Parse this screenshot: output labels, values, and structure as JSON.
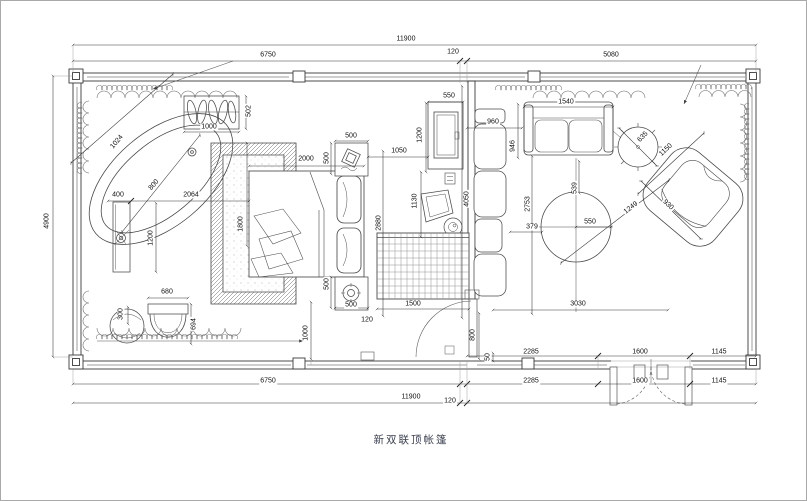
{
  "title": "新双联顶帐篷",
  "colors": {
    "background": "#ffffff",
    "line": "#3a3a3a",
    "title": "#3c4150"
  },
  "dimension_labels": [
    {
      "t": "11900",
      "x": 405,
      "y": 38,
      "r": 0
    },
    {
      "t": "6750",
      "x": 267,
      "y": 54,
      "r": 0
    },
    {
      "t": "120",
      "x": 452,
      "y": 51,
      "r": 0
    },
    {
      "t": "5080",
      "x": 610,
      "y": 54,
      "r": 0
    },
    {
      "t": "4900",
      "x": 46,
      "y": 220,
      "r": -90
    },
    {
      "t": "1024",
      "x": 116,
      "y": 141,
      "r": -49
    },
    {
      "t": "800",
      "x": 153,
      "y": 184,
      "r": -49
    },
    {
      "t": "1000",
      "x": 208,
      "y": 126,
      "r": 0
    },
    {
      "t": "502",
      "x": 248,
      "y": 110,
      "r": -90
    },
    {
      "t": "400",
      "x": 117,
      "y": 194,
      "r": 0
    },
    {
      "t": "2064",
      "x": 190,
      "y": 194,
      "r": 0
    },
    {
      "t": "1200",
      "x": 150,
      "y": 237,
      "r": -90
    },
    {
      "t": "300",
      "x": 120,
      "y": 313,
      "r": -90
    },
    {
      "t": "680",
      "x": 166,
      "y": 291,
      "r": 0
    },
    {
      "t": "694",
      "x": 193,
      "y": 323,
      "r": -90
    },
    {
      "t": "1800",
      "x": 240,
      "y": 223,
      "r": -90
    },
    {
      "t": "2000",
      "x": 305,
      "y": 158,
      "r": 0
    },
    {
      "t": "500",
      "x": 350,
      "y": 135,
      "r": 0
    },
    {
      "t": "500",
      "x": 326,
      "y": 157,
      "r": -90
    },
    {
      "t": "500",
      "x": 326,
      "y": 283,
      "r": -90
    },
    {
      "t": "500",
      "x": 350,
      "y": 304,
      "r": 0
    },
    {
      "t": "2880",
      "x": 378,
      "y": 222,
      "r": -90
    },
    {
      "t": "1500",
      "x": 412,
      "y": 303,
      "r": 0
    },
    {
      "t": "120",
      "x": 366,
      "y": 319,
      "r": 0
    },
    {
      "t": "1000",
      "x": 305,
      "y": 332,
      "r": -90
    },
    {
      "t": "550",
      "x": 448,
      "y": 95,
      "r": 0
    },
    {
      "t": "1200",
      "x": 419,
      "y": 134,
      "r": -90
    },
    {
      "t": "1050",
      "x": 398,
      "y": 150,
      "r": 0
    },
    {
      "t": "1130",
      "x": 414,
      "y": 200,
      "r": -90
    },
    {
      "t": "4050",
      "x": 466,
      "y": 198,
      "r": -90
    },
    {
      "t": "960",
      "x": 492,
      "y": 121,
      "r": 0
    },
    {
      "t": "946",
      "x": 512,
      "y": 145,
      "r": -90
    },
    {
      "t": "1540",
      "x": 565,
      "y": 101,
      "r": 0
    },
    {
      "t": "2753",
      "x": 527,
      "y": 203,
      "r": -90
    },
    {
      "t": "539",
      "x": 574,
      "y": 187,
      "r": -90
    },
    {
      "t": "550",
      "x": 589,
      "y": 221,
      "r": 0
    },
    {
      "t": "379",
      "x": 531,
      "y": 226,
      "r": 0
    },
    {
      "t": "1249",
      "x": 630,
      "y": 207,
      "r": -38
    },
    {
      "t": "635",
      "x": 642,
      "y": 136,
      "r": -45
    },
    {
      "t": "1150",
      "x": 665,
      "y": 149,
      "r": -43
    },
    {
      "t": "930",
      "x": 667,
      "y": 204,
      "r": 43
    },
    {
      "t": "3030",
      "x": 577,
      "y": 303,
      "r": 0
    },
    {
      "t": "800",
      "x": 472,
      "y": 334,
      "r": -90
    },
    {
      "t": "50",
      "x": 487,
      "y": 356,
      "r": -90
    },
    {
      "t": "2285",
      "x": 530,
      "y": 351,
      "r": 0
    },
    {
      "t": "1600",
      "x": 639,
      "y": 351,
      "r": 0
    },
    {
      "t": "1145",
      "x": 718,
      "y": 351,
      "r": 0
    },
    {
      "t": "6750",
      "x": 267,
      "y": 380,
      "r": 0
    },
    {
      "t": "2285",
      "x": 530,
      "y": 380,
      "r": 0
    },
    {
      "t": "1600",
      "x": 639,
      "y": 380,
      "r": 0
    },
    {
      "t": "1145",
      "x": 718,
      "y": 380,
      "r": 0
    },
    {
      "t": "11900",
      "x": 410,
      "y": 396,
      "r": 0
    },
    {
      "t": "120",
      "x": 449,
      "y": 400,
      "r": 0
    }
  ]
}
